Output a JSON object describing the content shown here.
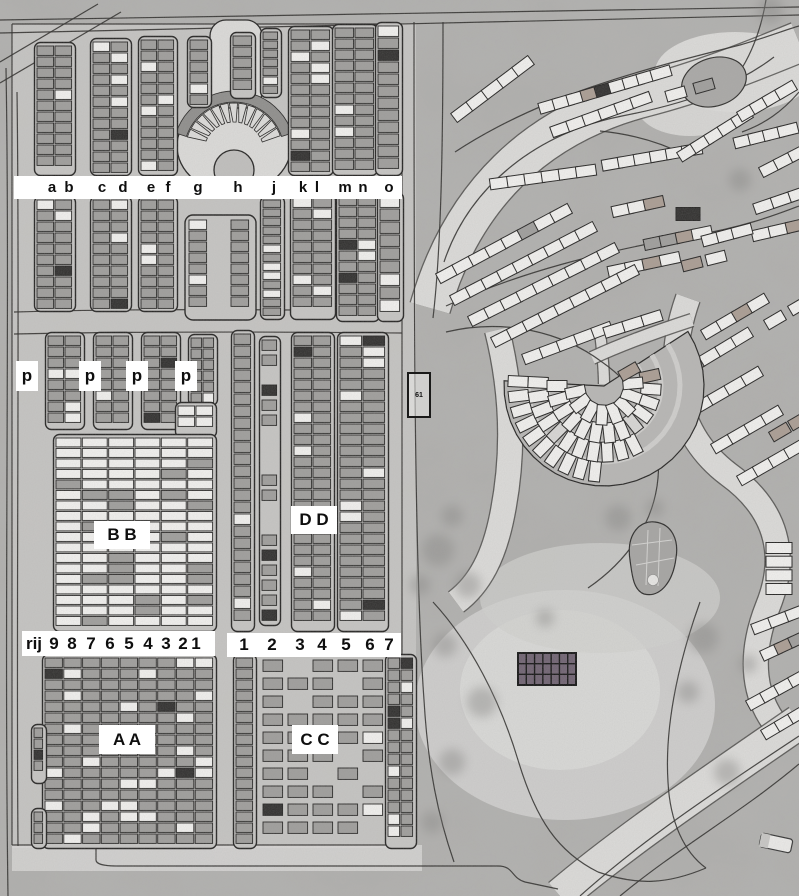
{
  "labels": {
    "column_letters": [
      "a",
      "b",
      "c",
      "d",
      "e",
      "f",
      "g",
      "h",
      "j",
      "k",
      "l",
      "m",
      "n",
      "o"
    ],
    "p_markers": [
      "p",
      "p",
      "p",
      "p"
    ],
    "section_labels": {
      "bb": "B B",
      "dd": "D D",
      "aa": "A A",
      "cc": "C C"
    },
    "row_header_tokens": [
      "rij",
      "9",
      "8",
      "7",
      "6",
      "5",
      "4",
      "3",
      "2",
      "1"
    ],
    "column_number_tokens": [
      "1",
      "2",
      "3",
      "4",
      "5",
      "6",
      "7"
    ],
    "small_plot_marker": "61"
  },
  "colors": {
    "ground": "#b3b2b0",
    "left_section_ground": "#cac9c7",
    "road_light": "#dcdbd9",
    "outline": "#222120",
    "plot_gray": "#9e9d9b",
    "plot_white": "#f2f1ef",
    "plot_black": "#2e2d2c",
    "plot_tan": "#aa9c92",
    "building_dark": "#6e6170",
    "label_bg": "#ffffff",
    "label_text": "#0e0e0e"
  }
}
